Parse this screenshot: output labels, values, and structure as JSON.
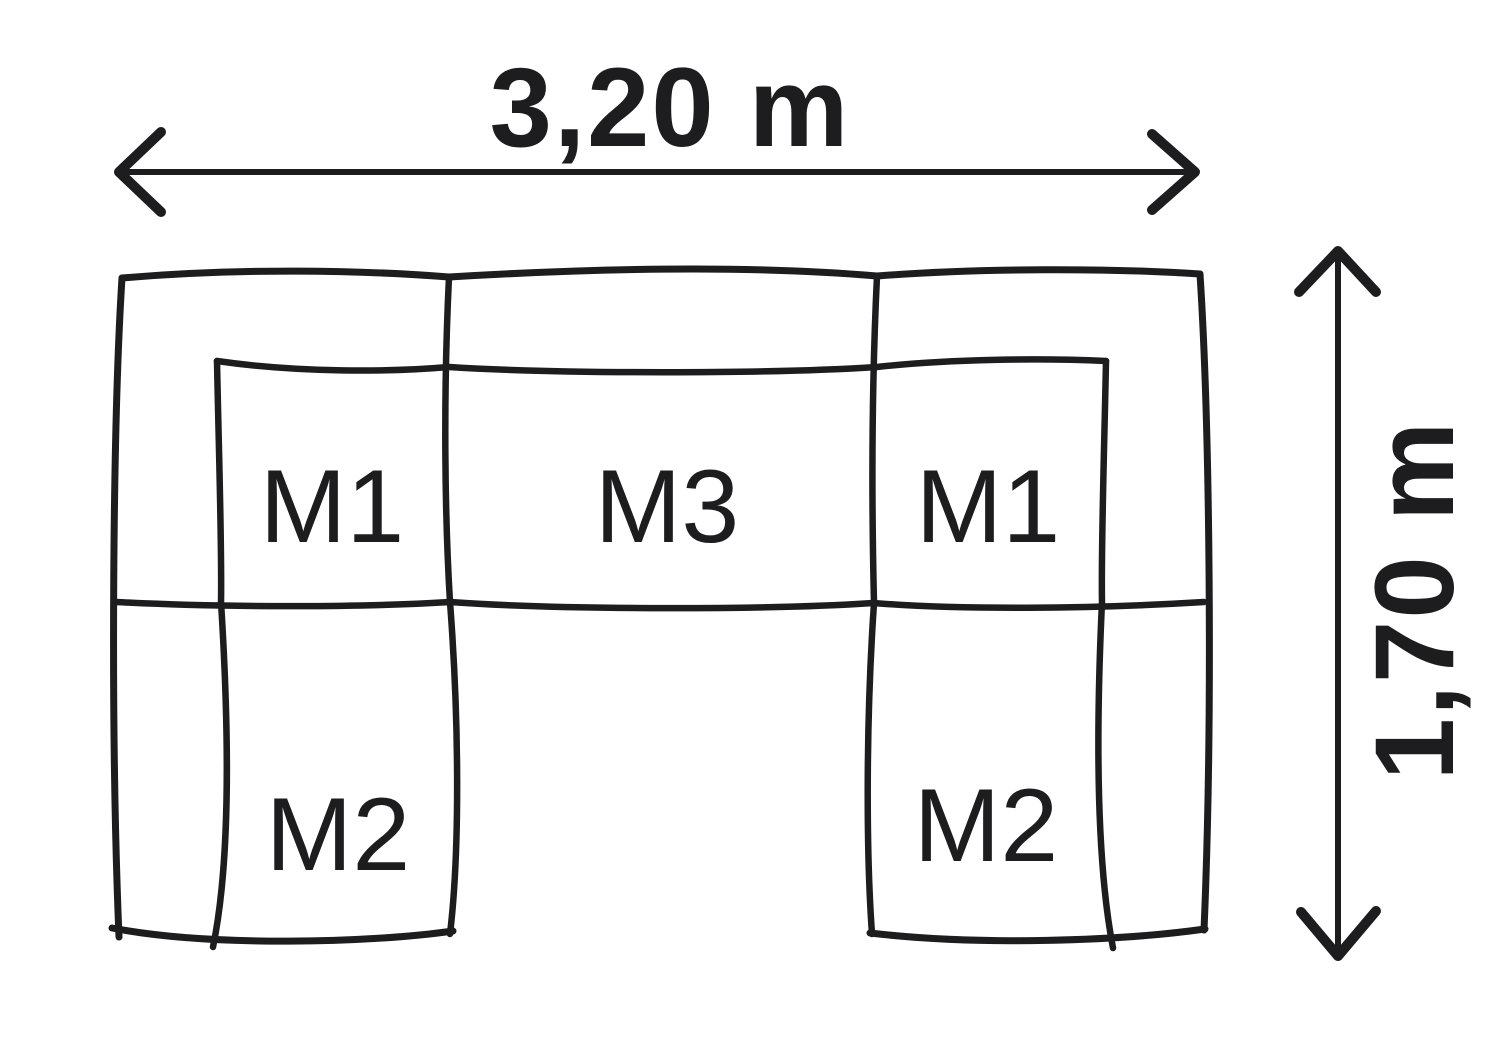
{
  "diagram": {
    "type": "sofa-top-view-dimension-plan",
    "background_color": "#ffffff",
    "line_color": "#1d1d1f",
    "dimensions": {
      "width_label": "3,20 m",
      "depth_label": "1,70 m"
    },
    "modules": {
      "left_seat": "M1",
      "center_seat": "M3",
      "right_seat": "M1",
      "left_chaise": "M2",
      "right_chaise": "M2"
    }
  }
}
